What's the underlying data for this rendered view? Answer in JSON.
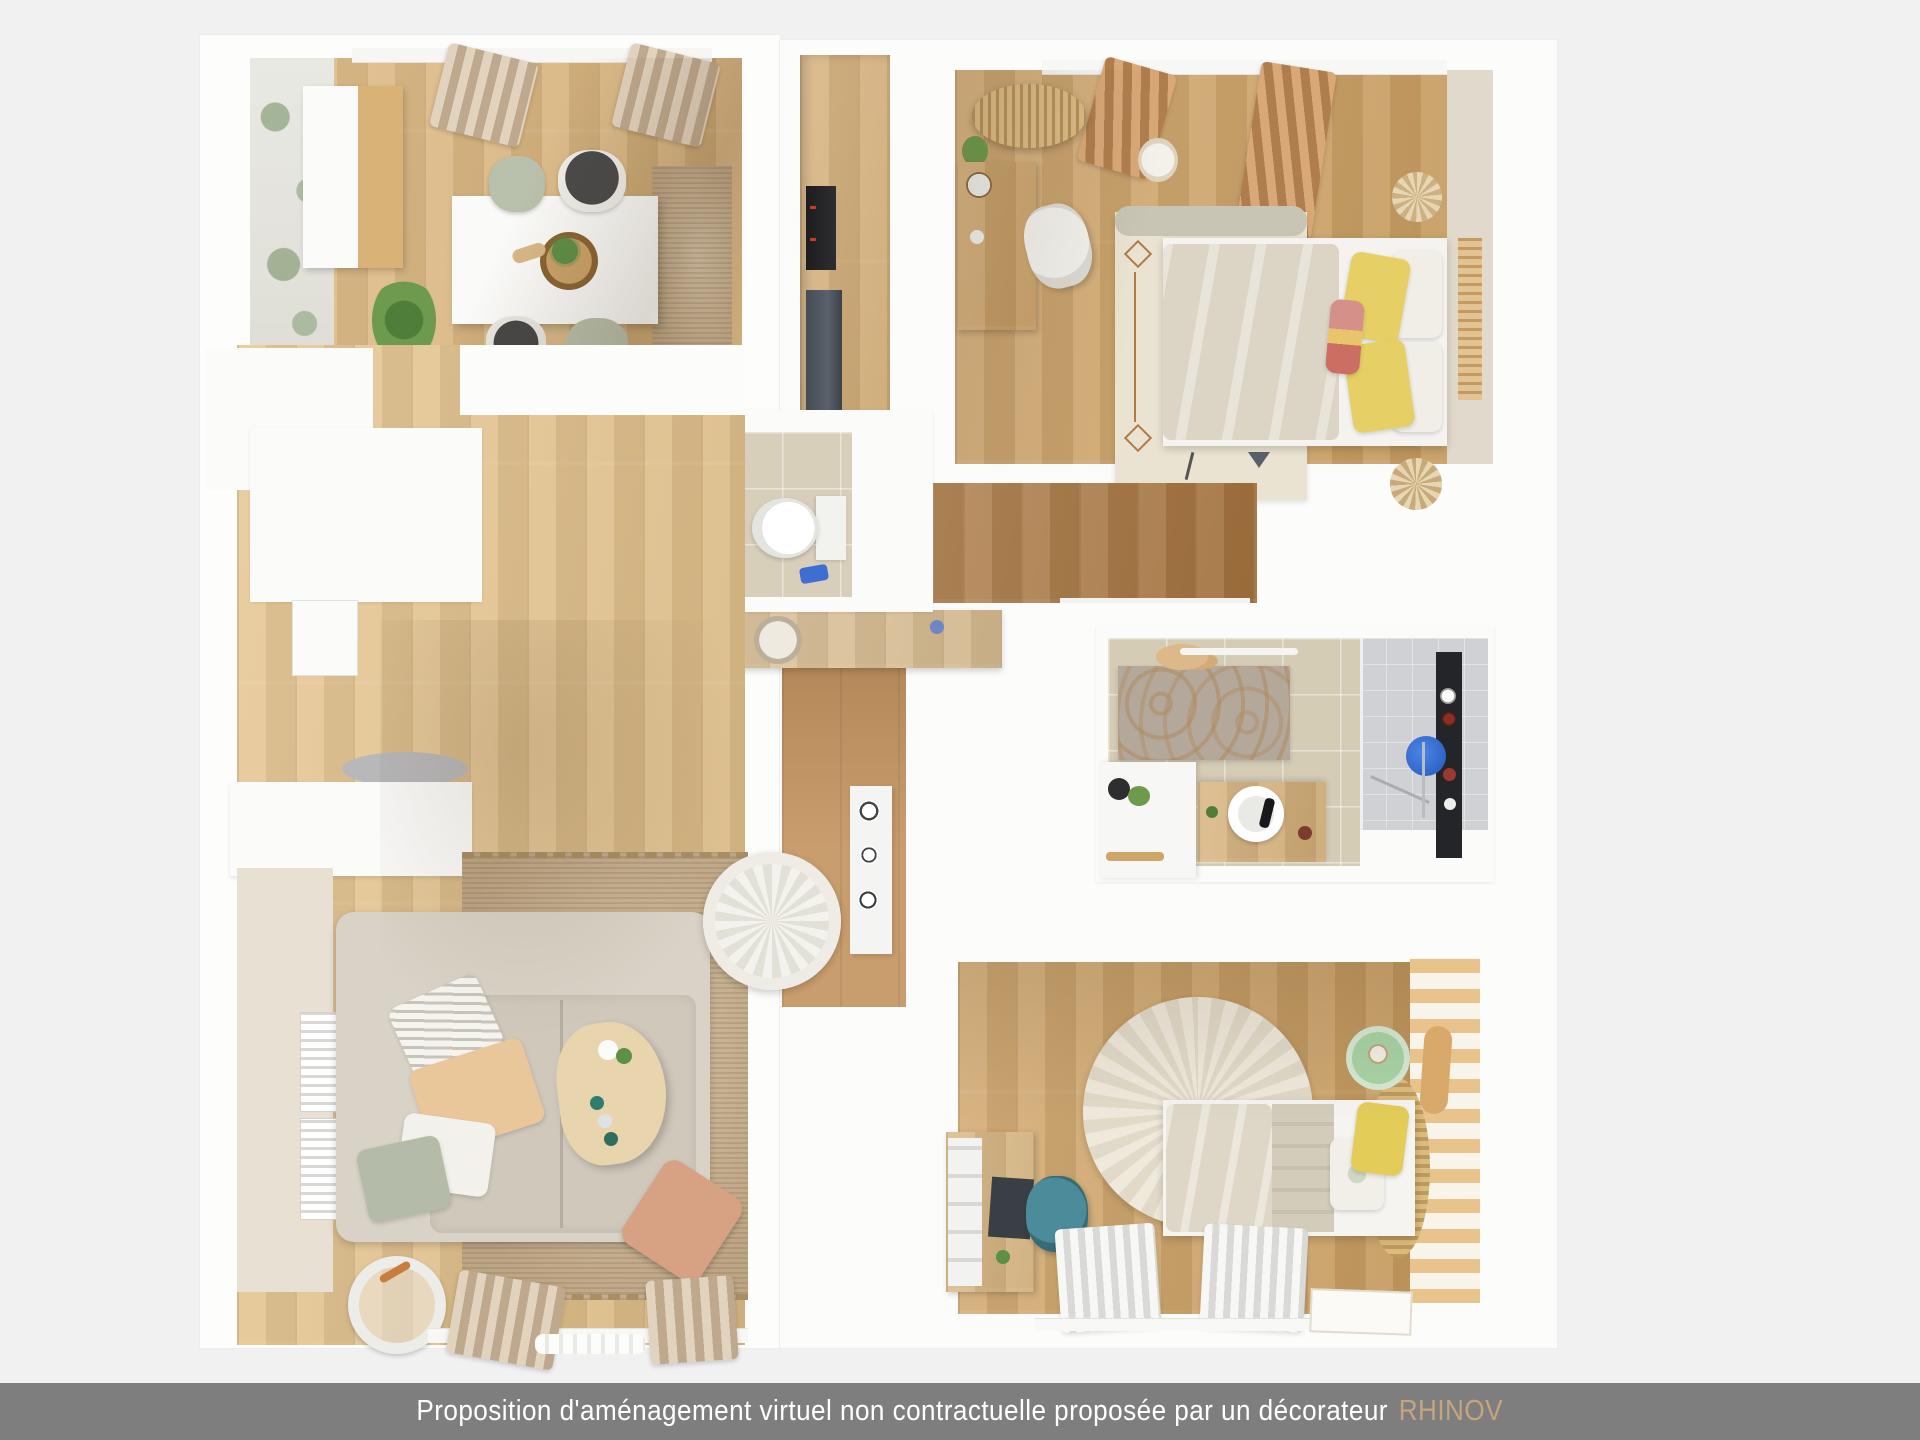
{
  "caption": {
    "text": "Proposition d'aménagement virtuel non contractuelle proposée par un décorateur",
    "brand": "RHINOV",
    "bar_color": "#7e7e7f",
    "text_color": "#ffffff",
    "brand_color": "#c5a57d"
  },
  "palette": {
    "page_background": "#f1f1f2",
    "sheet_white": "#fdfdfc",
    "wood_light": "#ddb67c",
    "wood_base": "#cfa263",
    "wood_mid": "#c08d55",
    "wood_dark": "#a9763f",
    "wall_beige": "#e7e0d3",
    "tile_beige": "#d8cfba",
    "shower_gray": "#d0d1d4",
    "rug_jute": "#c9b08d",
    "rug_cream": "#ece6d8",
    "sofa_beige": "#d9d2c6",
    "duvet_beige": "#dcd5c5",
    "pillow_yellow": "#e5ce5c",
    "pillow_pink": "#d49089",
    "pillow_sage": "#b5bba9",
    "pouf_terracotta": "#d7a284",
    "chair_teal": "#3e7e8e",
    "mirror_blue": "#2f6bd8",
    "plant_green": "#5d8f46",
    "appliance_black": "#1d1d1f",
    "appliance_slate": "#464c54"
  }
}
